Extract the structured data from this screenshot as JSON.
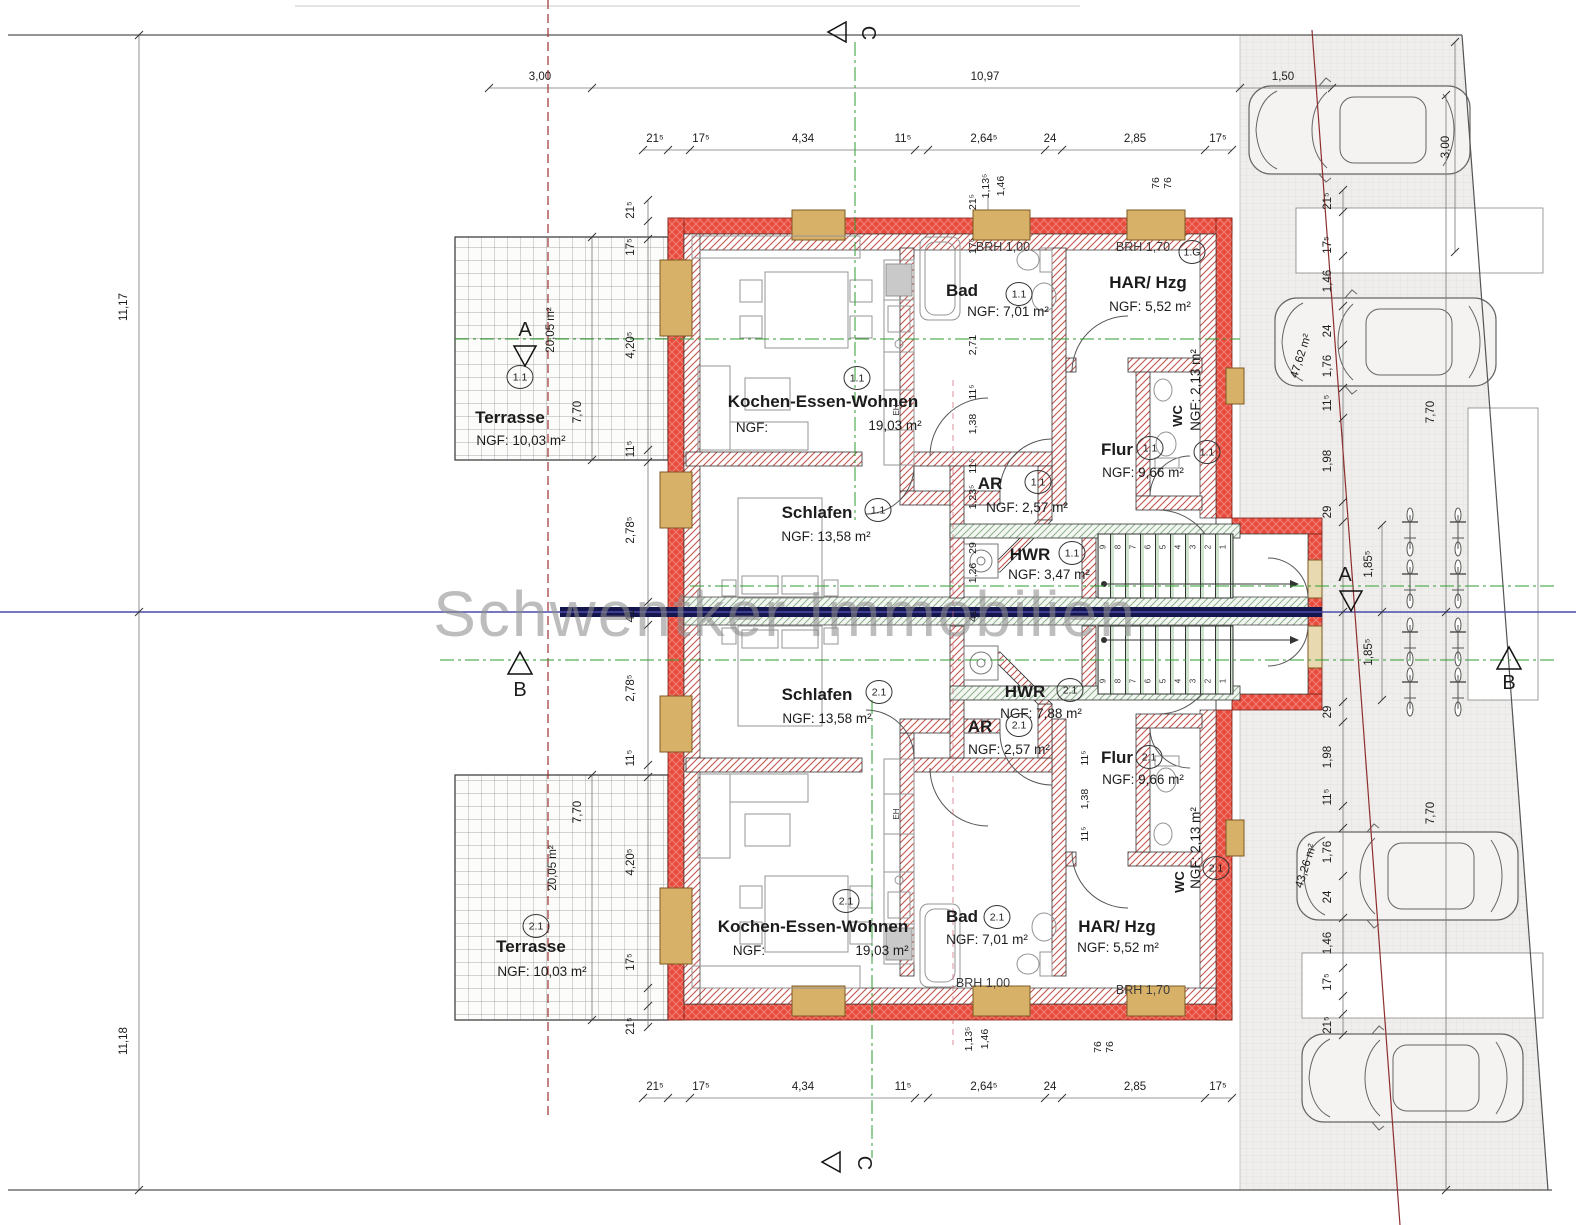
{
  "watermark": "Schwentker Immobilien",
  "site": {
    "boundary_left_top": "11,17",
    "boundary_left_bottom": "11,18",
    "top_ruler": [
      "3,00",
      "10,97"
    ],
    "top_right": "1,50",
    "right_top_vertical": "3,00",
    "right_depth_top": "7,70",
    "right_depth_bottom": "7,70",
    "parking_area_top": "47,62 m²",
    "parking_area_bottom": "43,26 m²"
  },
  "section_markers": {
    "a": "A",
    "b": "B",
    "c": "C"
  },
  "chains": {
    "top": [
      "21⁵",
      "17⁵",
      "4,34",
      "11⁵",
      "2,64⁵",
      "24",
      "2,85",
      "17⁵"
    ],
    "bottom": [
      "21⁵",
      "17⁵",
      "4,34",
      "11⁵",
      "2,64⁵",
      "24",
      "2,85",
      "17⁵"
    ],
    "left": [
      "21⁵",
      "17⁵",
      "4,20⁵",
      "11⁵",
      "2,78⁵",
      "41",
      "2,78⁵",
      "11⁵",
      "4,20⁵",
      "17⁵",
      "21⁵"
    ],
    "right_upper": [
      "21⁵",
      "17⁵",
      "1,46",
      "24",
      "1,76",
      "11⁵",
      "1,98",
      "29",
      "1,85⁵"
    ],
    "right_lower": [
      "1,85⁵",
      "29",
      "1,98",
      "11⁵",
      "1,76",
      "24",
      "1,46",
      "17⁵",
      "21⁵"
    ],
    "inner_top": [
      "21⁵",
      "17⁵",
      "2,71",
      "11⁵",
      "1,38",
      "11⁵",
      "1,23⁵",
      "29",
      "1,26"
    ],
    "inner_bottom": [
      "11⁵",
      "1,38",
      "11⁵"
    ],
    "center_party": [
      "41"
    ],
    "top_door": [
      "1,13⁵",
      "1,46"
    ],
    "top_sill": [
      "76",
      "76"
    ],
    "bottom_door": [
      "1,13⁵",
      "1,46"
    ],
    "bottom_sill": [
      "76",
      "76"
    ]
  },
  "terrace_dims": {
    "t1_depth": "7,70",
    "t1_area": "20,05 m²",
    "t2_depth": "7,70",
    "t2_area": "20,05 m²"
  },
  "apartment1": {
    "kew": {
      "name": "Kochen-Essen-Wohnen",
      "marker": "1.1",
      "ngf_label": "NGF:",
      "area": "19,03 m²"
    },
    "bad": {
      "name": "Bad",
      "marker": "1.1",
      "ngf": "NGF: 7,01 m²",
      "sill": "BRH 1,00"
    },
    "har": {
      "name": "HAR/ Hzg",
      "ngf": "NGF: 5,52 m²",
      "sill": "BRH 1,70",
      "marker": "1.G"
    },
    "wc": {
      "name": "WC",
      "marker": "1.1",
      "ngf": "NGF: 2,13 m²"
    },
    "flur": {
      "name": "Flur",
      "marker": "1.1",
      "ngf": "NGF: 9,66 m²"
    },
    "ar": {
      "name": "AR",
      "marker": "1.1",
      "ngf": "NGF: 2,57 m²"
    },
    "hwr": {
      "name": "HWR",
      "marker": "1.1",
      "ngf": "NGF: 3,47 m²"
    },
    "schlafen": {
      "name": "Schlafen",
      "marker": "1.1",
      "ngf": "NGF: 13,58 m²"
    },
    "terrasse": {
      "name": "Terrasse",
      "marker": "1.1",
      "ngf": "NGF: 10,03 m²"
    },
    "stove": "EH"
  },
  "apartment2": {
    "kew": {
      "name": "Kochen-Essen-Wohnen",
      "marker": "2.1",
      "ngf_label": "NGF:",
      "area": "19,03 m²"
    },
    "bad": {
      "name": "Bad",
      "marker": "2.1",
      "ngf": "NGF: 7,01 m²",
      "sill": "BRH 1,00"
    },
    "har": {
      "name": "HAR/ Hzg",
      "ngf": "NGF: 5,52 m²",
      "sill": "BRH 1,70"
    },
    "wc": {
      "name": "WC",
      "marker": "2.1",
      "ngf": "NGF: 2,13 m²"
    },
    "flur": {
      "name": "Flur",
      "marker": "2.1",
      "ngf": "NGF: 9,66 m²"
    },
    "ar": {
      "name": "AR",
      "marker": "2.1",
      "ngf": "NGF: 2,57 m²"
    },
    "hwr": {
      "name": "HWR",
      "marker": "2.1",
      "ngf": "NGF: 7,88 m²"
    },
    "schlafen": {
      "name": "Schlafen",
      "marker": "2.1",
      "ngf": "NGF: 13,58 m²"
    },
    "terrasse": {
      "name": "Terrasse",
      "marker": "2.1",
      "ngf": "NGF: 10,03 m²"
    },
    "stove": "EH"
  },
  "stairs": {
    "steps_up": [
      "1",
      "2",
      "3",
      "4",
      "5",
      "6",
      "7",
      "8",
      "9"
    ],
    "steps_down": [
      "1",
      "2",
      "3",
      "4",
      "5",
      "6",
      "7",
      "8",
      "9"
    ]
  }
}
